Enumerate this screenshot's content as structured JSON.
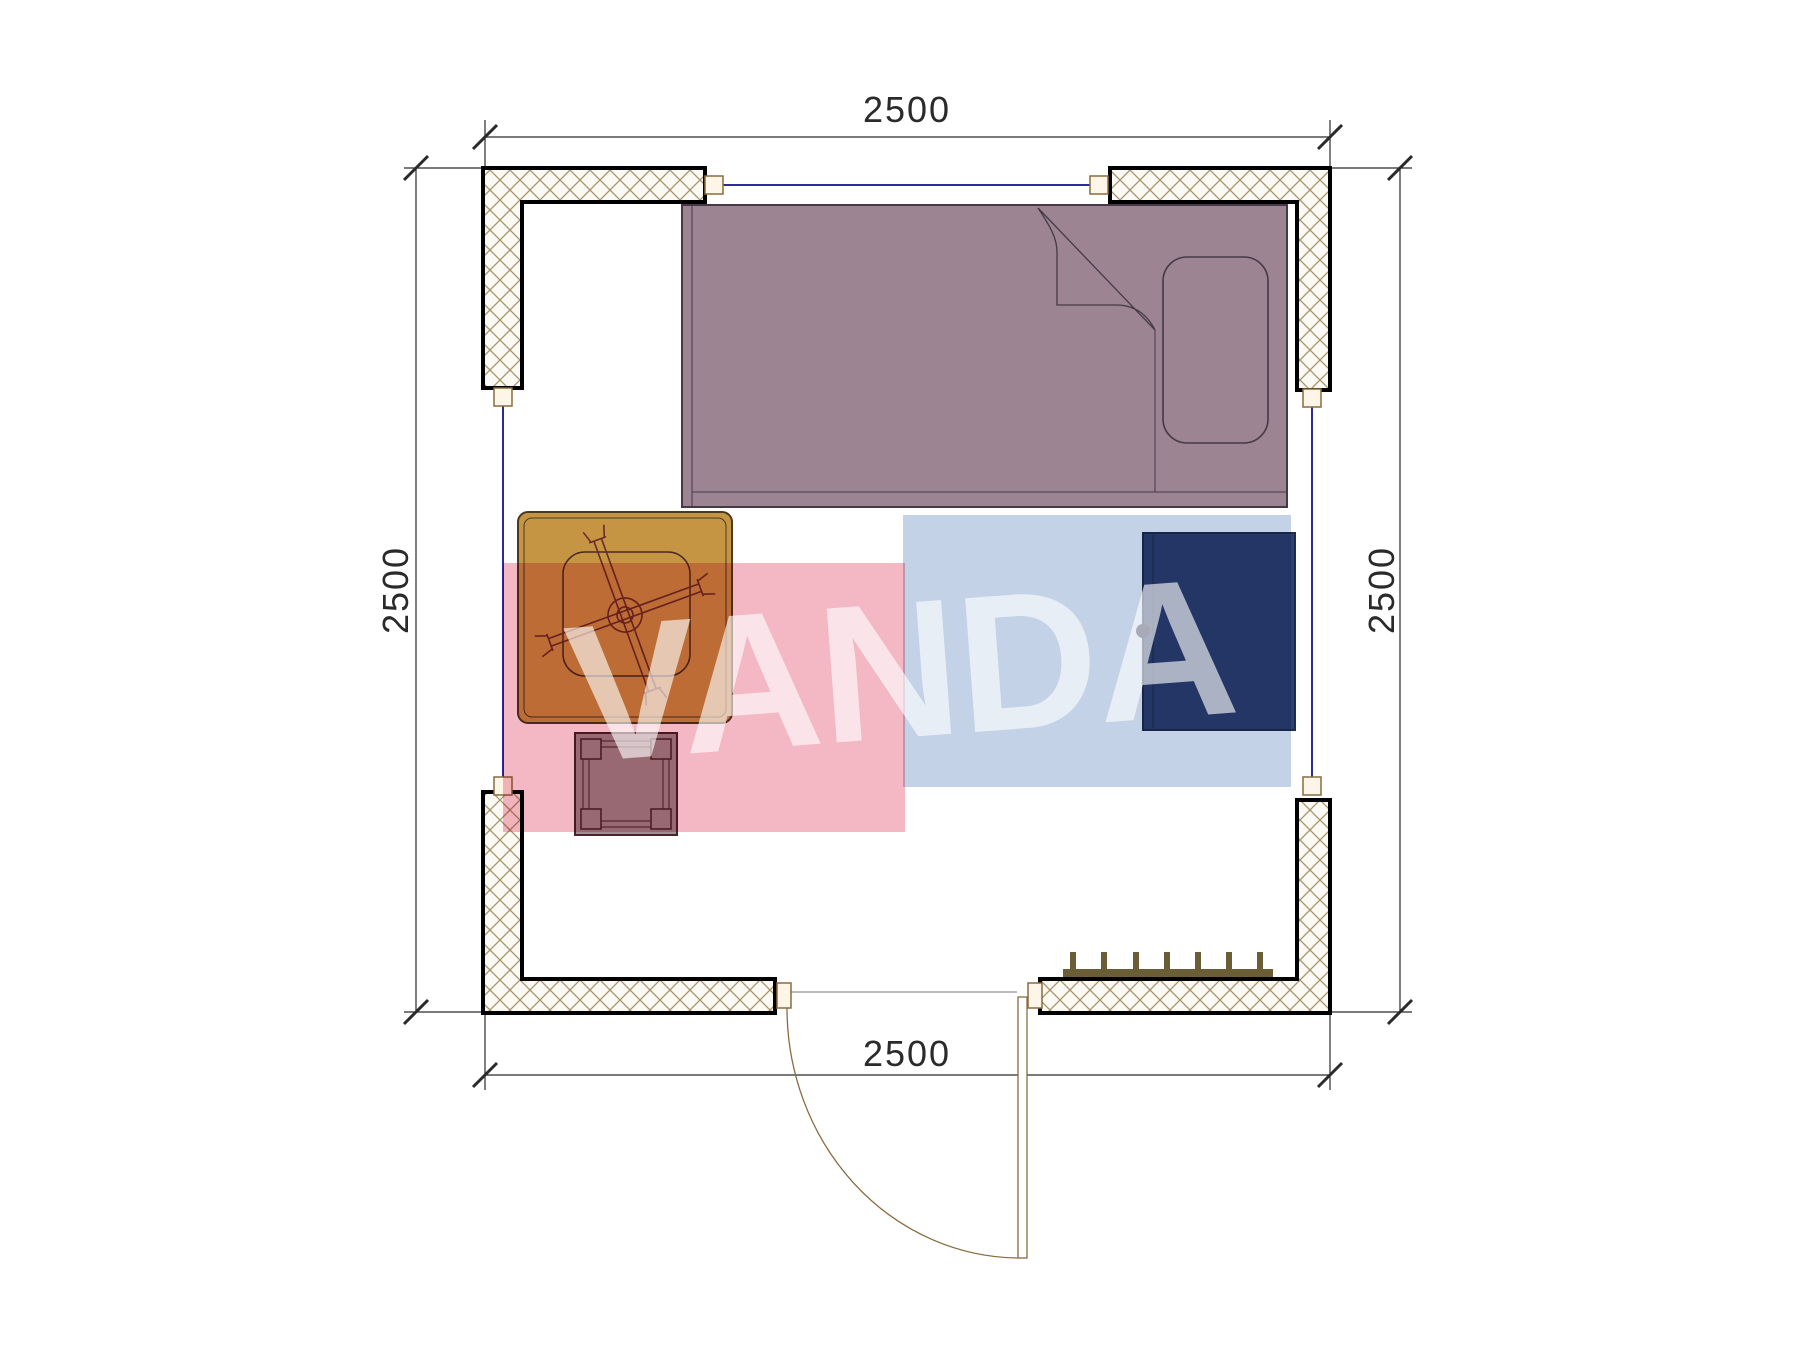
{
  "watermark": {
    "text": "VANDA",
    "pink_band_color": "#f4b8c4",
    "blue_band_color": "#c3d2e6",
    "letter_color": "rgba(255,255,255,0.62)"
  },
  "dimensions": {
    "top": "2500",
    "bottom": "2500",
    "left": "2500",
    "right": "2500"
  },
  "colors": {
    "wall_outline": "#000000",
    "wall_hatch": "#a8946a",
    "window_line": "#2b2b9e",
    "window_marker_fill": "#fdf6e8",
    "window_marker_border": "#8a6b3f",
    "bed_fill": "#9c8493",
    "bed_outline": "#453a44",
    "desk_fill": "#c69544",
    "desk_outline": "#4a3a20",
    "chair_line": "#6b2c26",
    "stool_fill": "#9f9096",
    "stool_outline": "#4a2228",
    "wardrobe_fill": "#2d4170",
    "wardrobe_outline": "#1e2c50",
    "radiator_fill": "#6b5d35",
    "door_line": "#8a6b3f",
    "dimension_line": "#2a2a2a"
  }
}
